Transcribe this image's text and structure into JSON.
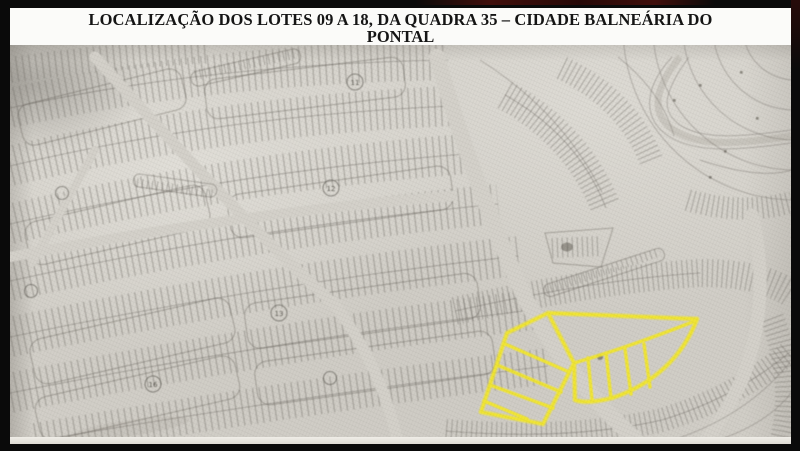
{
  "title": {
    "line1": "LOCALIZAÇÃO DOS LOTES 09 A 18, DA QUADRA 35 – CIDADE BALNEÁRIA DO",
    "line2": "PONTAL"
  },
  "map": {
    "paper_color": "#d2cfc8",
    "ink_color": "#6f6b64",
    "badges": [
      {
        "label": "11"
      },
      {
        "label": "12"
      },
      {
        "label": "13"
      },
      {
        "label": "16"
      }
    ],
    "highlight": {
      "color": "#f3e72b",
      "lots": "09 a 18",
      "quadra": "35"
    }
  }
}
